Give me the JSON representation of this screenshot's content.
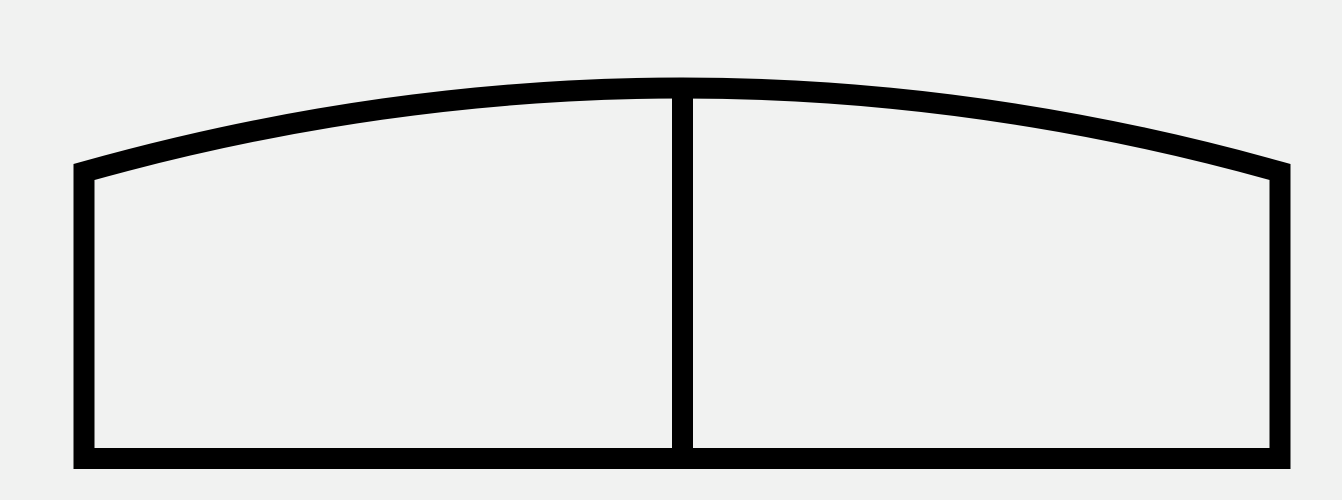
{
  "figure": {
    "name": "arched-two-panel-outline",
    "background_color": "#f1f2f1",
    "stroke_color": "#000000",
    "stroke_width": "21",
    "viewbox": "0 0 1342 500",
    "canvas_width": "1342",
    "canvas_height": "500",
    "outline_path": "M 84 458.5 L 84 172 Q 682 4 1280 172 L 1280 458.5 Z",
    "divider_path": "M 682.5 86 L 682.5 458.5"
  }
}
